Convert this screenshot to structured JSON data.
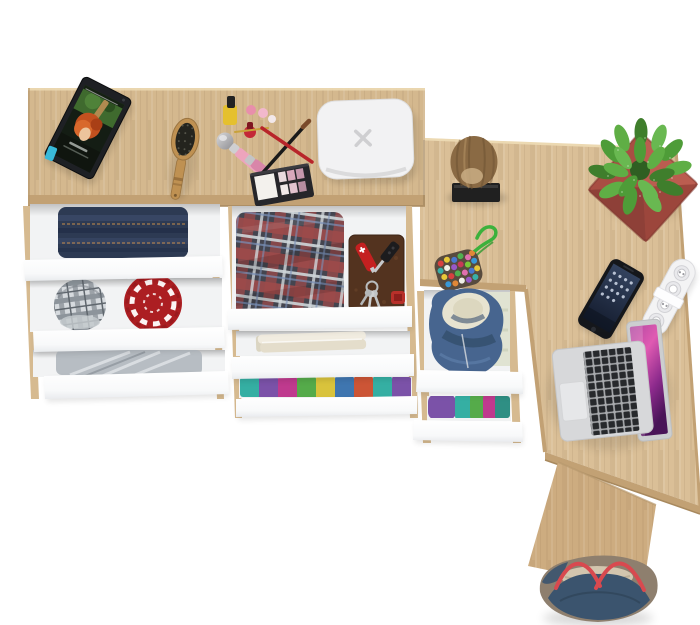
{
  "scene": {
    "background": "#ffffff",
    "description": "Top-down product render of an L-shaped oak dressing table / desk with open white drawers"
  },
  "colors": {
    "oak_main": "#d4b88e",
    "oak_return": "#dabf97",
    "oak_panel": "#cdac80",
    "oak_edge": "#c2a174",
    "oak_edge_dark": "#a8895e",
    "oak_rail": "#d6ba90",
    "drawer_interior": "#f2f3f4",
    "jeans": "#2d3a53",
    "red_hat": "#ac1e22",
    "gray_clothes": "#b7bdc3",
    "towel": "#f1ece0",
    "hoodie": "#47658f",
    "hoodie_lining": "#e7e3d0",
    "log": "#8a6a44",
    "log_base": "#202020",
    "plant_pot": "#ad5247",
    "leaf_green": "#4e9c38",
    "device_white": "#f2f2f3",
    "tablet_body": "#1e2024",
    "phone_body": "#15171b",
    "strip_white": "#f3f3f4",
    "laptop_silver": "#d7d8da",
    "bag_navy": "#3b546e",
    "bag_taupe": "#8e7f6e",
    "bag_rope": "#d8494f",
    "book_brown": "#53331f",
    "knife_red": "#c42020",
    "keychain_rope": "#3cb13c",
    "brush_wood": "#bf9152"
  },
  "objects": [
    {
      "name": "main-desk",
      "desc": "oak dressing table top"
    },
    {
      "name": "desk-return",
      "desc": "oak desk return wing"
    },
    {
      "name": "side-panel",
      "desc": "oak side leg panel"
    },
    {
      "name": "tablet",
      "desc": "black tablet showing movie still"
    },
    {
      "name": "hairbrush",
      "desc": "wooden hairbrush"
    },
    {
      "name": "cosmetics-set",
      "desc": "nail polish, lipsticks, brushes, eyeshadow palette"
    },
    {
      "name": "smart-hub-device",
      "desc": "white rounded square device with X mark"
    },
    {
      "name": "log-stool",
      "desc": "wood log on black base"
    },
    {
      "name": "potted-plant",
      "desc": "green speckled plant in terracotta pot"
    },
    {
      "name": "bead-pouch-keychain",
      "desc": "multicolor bead pouch with green rope"
    },
    {
      "name": "smartphone",
      "desc": "smartphone face up"
    },
    {
      "name": "power-strip",
      "desc": "white power strip"
    },
    {
      "name": "laptop",
      "desc": "open silver laptop with magenta screen"
    },
    {
      "name": "tote-bag",
      "desc": "navy and taupe tote with red rope handles"
    },
    {
      "name": "folded-jeans",
      "desc": "drawer with folded jeans"
    },
    {
      "name": "plaid-cap",
      "desc": "gray plaid cap"
    },
    {
      "name": "red-knit-hat",
      "desc": "red patterned hat"
    },
    {
      "name": "gray-sweater",
      "desc": "folded gray clothes"
    },
    {
      "name": "plaid-shirt",
      "desc": "red tartan shirt"
    },
    {
      "name": "leather-book",
      "desc": "brown leather book with knife and keys"
    },
    {
      "name": "folded-towels",
      "desc": "cream towels"
    },
    {
      "name": "folded-colorful-shirts",
      "desc": "row of colorful folded shirts"
    },
    {
      "name": "blue-hoodie",
      "desc": "blue hoodie in drawer"
    },
    {
      "name": "folded-purple-teal-shirts",
      "desc": "purple and teal folded shirts"
    }
  ]
}
